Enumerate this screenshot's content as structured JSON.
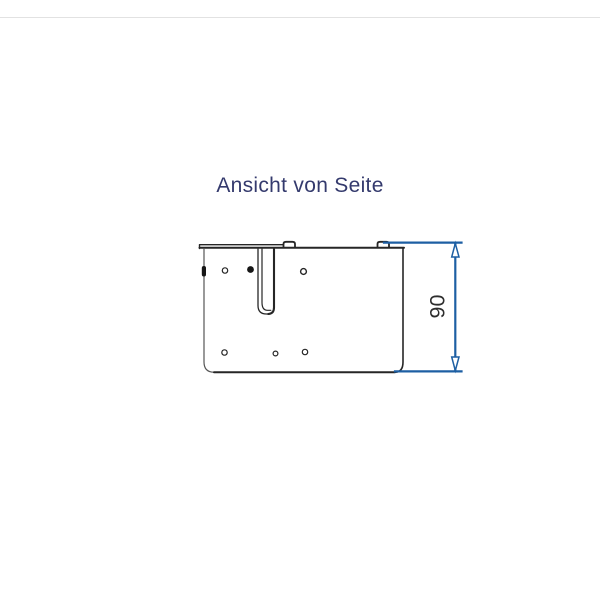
{
  "title": {
    "text": "Ansicht von Seite",
    "color": "#343a6d"
  },
  "dimension": {
    "value": "90",
    "color": "#1d5fa3",
    "text_color": "#2d2d2d"
  },
  "drawing": {
    "line_color": "#262626",
    "background": "#ffffff"
  }
}
